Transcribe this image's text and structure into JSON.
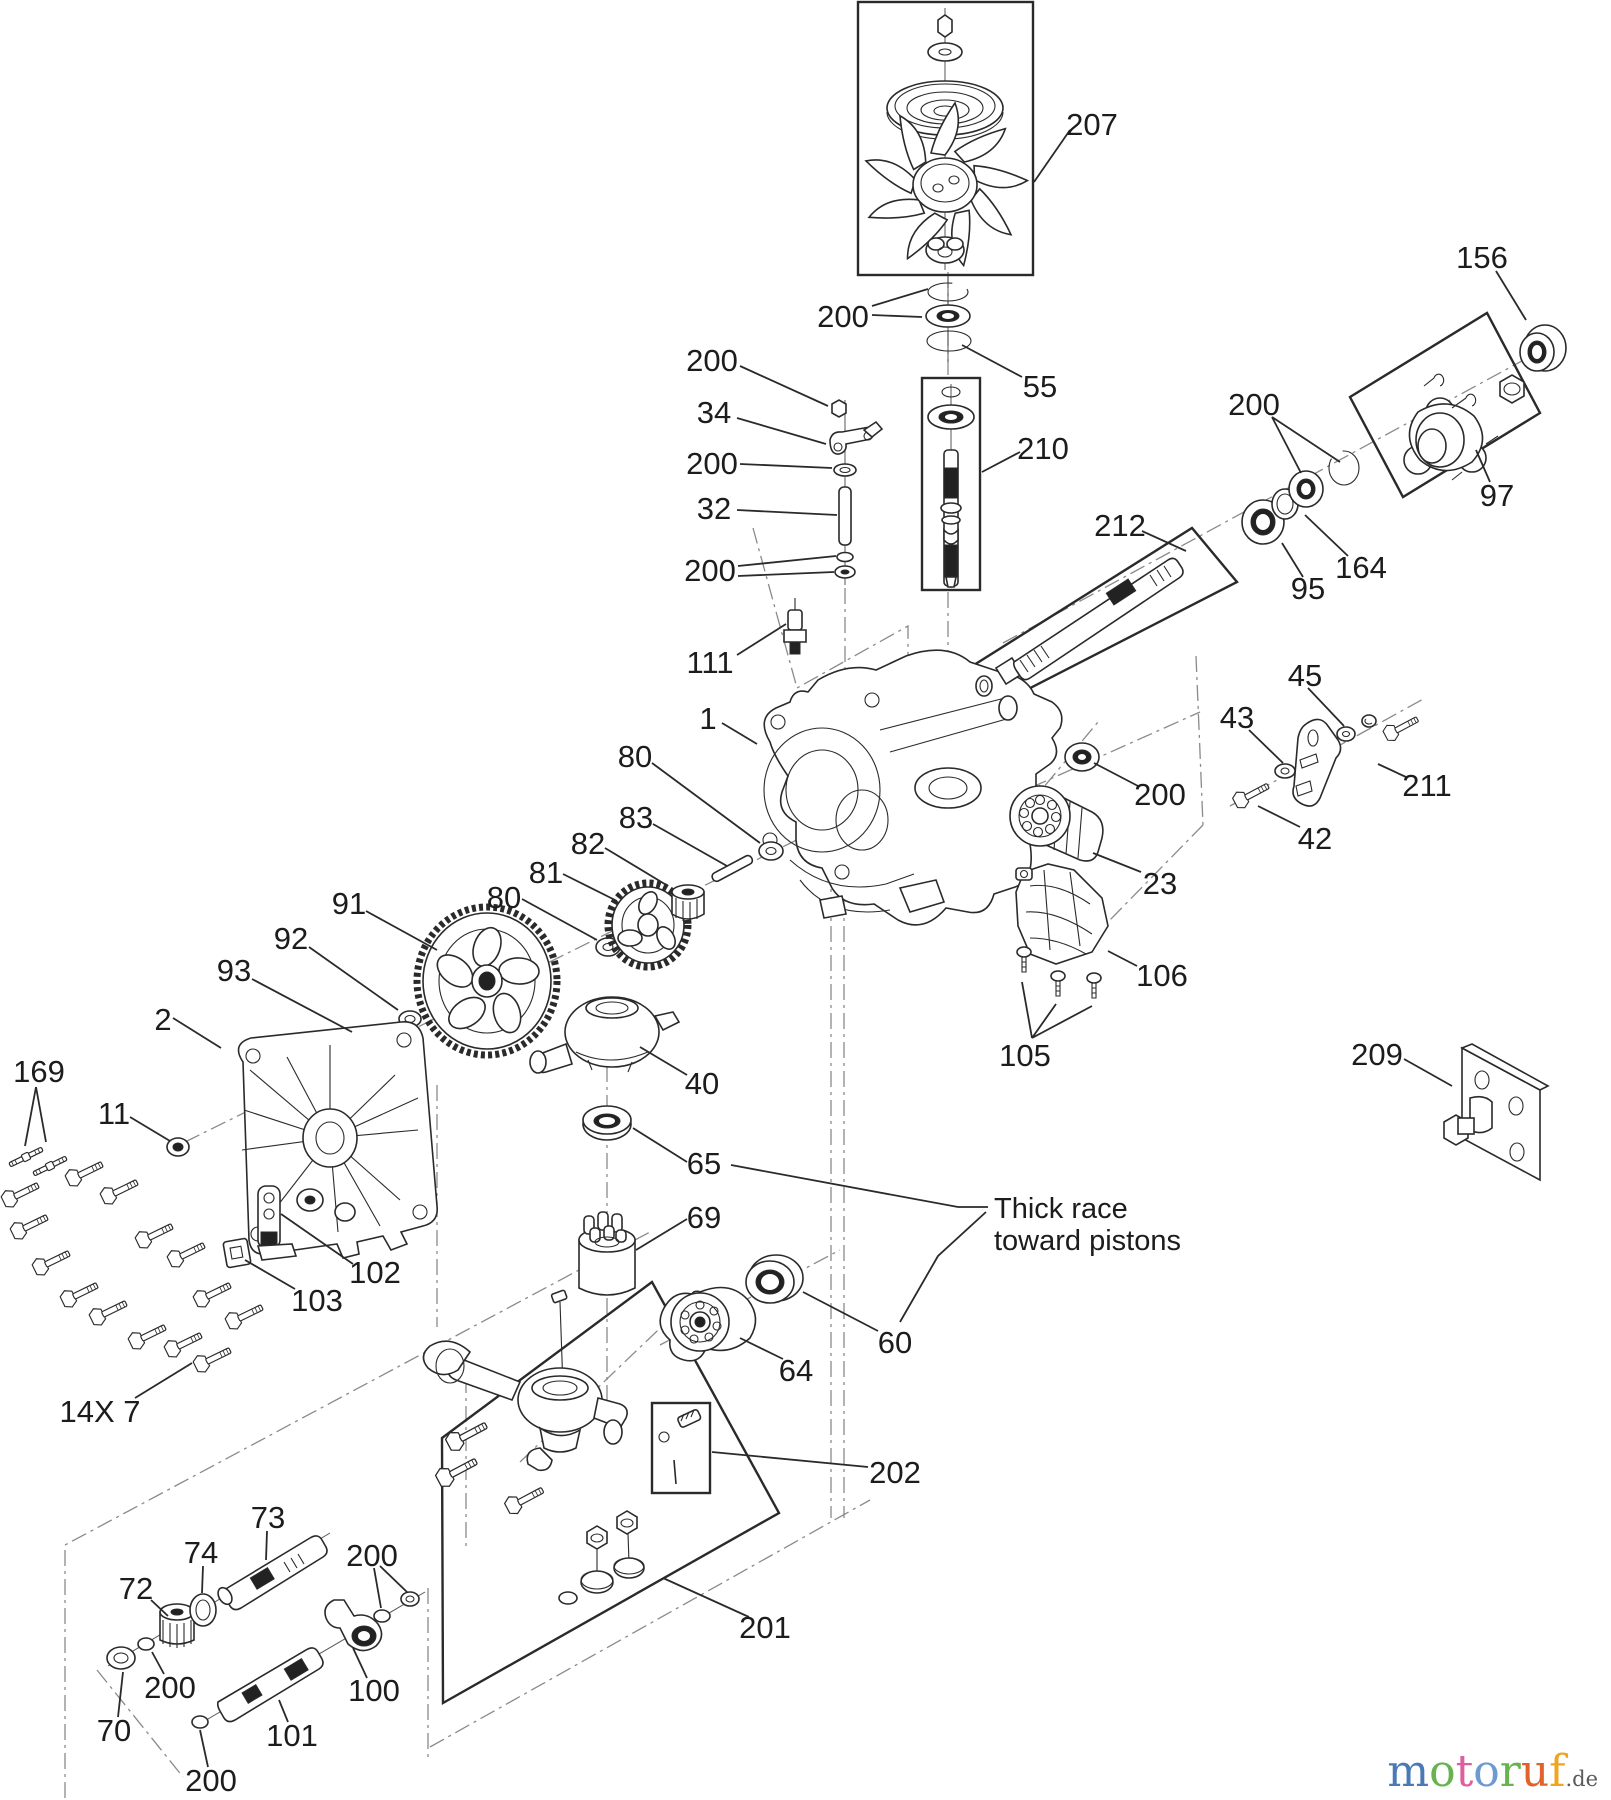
{
  "page": {
    "background": "#ffffff",
    "ink_color": "#2a2a2a",
    "construction_line_color": "#8a8a8a"
  },
  "note": {
    "line1": "Thick race",
    "line2": "toward pistons"
  },
  "watermark": {
    "letters": [
      {
        "ch": "m",
        "color": "#4a7ab5"
      },
      {
        "ch": "o",
        "color": "#67b34e"
      },
      {
        "ch": "t",
        "color": "#de5f9f"
      },
      {
        "ch": "o",
        "color": "#6d9ad0"
      },
      {
        "ch": "r",
        "color": "#67b34e"
      },
      {
        "ch": "u",
        "color": "#e2622d"
      },
      {
        "ch": "f",
        "color": "#efa51f"
      }
    ],
    "suffix": ".de"
  },
  "callouts": [
    {
      "label": "207"
    },
    {
      "label": "200"
    },
    {
      "label": "55"
    },
    {
      "label": "210"
    },
    {
      "label": "200"
    },
    {
      "label": "34"
    },
    {
      "label": "200"
    },
    {
      "label": "32"
    },
    {
      "label": "200"
    },
    {
      "label": "111"
    },
    {
      "label": "1"
    },
    {
      "label": "156"
    },
    {
      "label": "200"
    },
    {
      "label": "97"
    },
    {
      "label": "212"
    },
    {
      "label": "95"
    },
    {
      "label": "164"
    },
    {
      "label": "45"
    },
    {
      "label": "43"
    },
    {
      "label": "211"
    },
    {
      "label": "42"
    },
    {
      "label": "200"
    },
    {
      "label": "23"
    },
    {
      "label": "106"
    },
    {
      "label": "105"
    },
    {
      "label": "209"
    },
    {
      "label": "80"
    },
    {
      "label": "83"
    },
    {
      "label": "82"
    },
    {
      "label": "81"
    },
    {
      "label": "80"
    },
    {
      "label": "91"
    },
    {
      "label": "92"
    },
    {
      "label": "93"
    },
    {
      "label": "2"
    },
    {
      "label": "169"
    },
    {
      "label": "11"
    },
    {
      "label": "102"
    },
    {
      "label": "103"
    },
    {
      "label": "14X 7"
    },
    {
      "label": "40"
    },
    {
      "label": "65"
    },
    {
      "label": "69"
    },
    {
      "label": "60"
    },
    {
      "label": "64"
    },
    {
      "label": "202"
    },
    {
      "label": "201"
    },
    {
      "label": "73"
    },
    {
      "label": "74"
    },
    {
      "label": "72"
    },
    {
      "label": "200"
    },
    {
      "label": "100"
    },
    {
      "label": "101"
    },
    {
      "label": "200"
    },
    {
      "label": "70"
    },
    {
      "label": "200"
    }
  ]
}
